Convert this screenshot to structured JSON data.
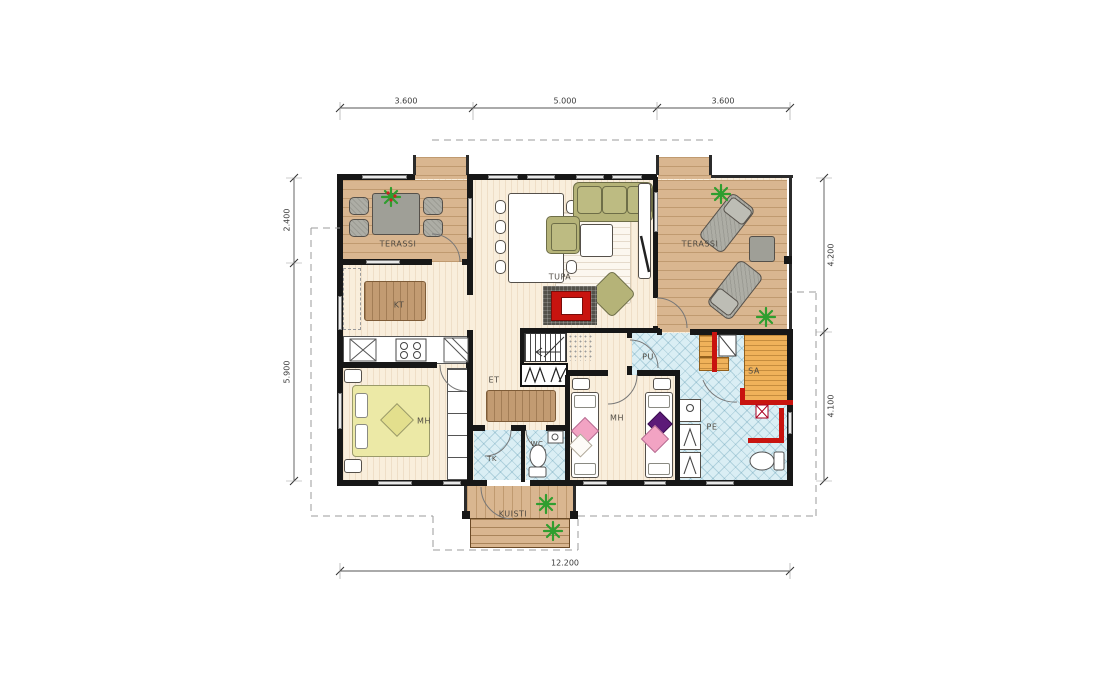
{
  "drawing": {
    "type": "architectural floor plan"
  },
  "rooms": {
    "terassi_left": "TERASSI",
    "terassi_right": "TERASSI",
    "tupa": "TUPA",
    "kt": "KT",
    "et": "ET",
    "mh_left": "MH",
    "mh_right": "MH",
    "tk": "TK",
    "wc": "WC",
    "pu": "PU",
    "sa": "SA",
    "pe": "PE",
    "kuisti": "KUISTI"
  },
  "dimensions": {
    "top": [
      "3.600",
      "5.000",
      "3.600"
    ],
    "left": [
      "2.400",
      "5.900"
    ],
    "right": [
      "4.200",
      "4.100"
    ],
    "bottom": [
      "12.200"
    ]
  },
  "colors": {
    "wall": "#171717",
    "wood_deck": "#d9b690",
    "interior_floor": "#f9eedc",
    "wet_room_tile": "#daeef4",
    "sauna_bench": "#f0b25a",
    "accent_red": "#c8140f",
    "furniture_olive": "#b5b378",
    "bed_yellow": "#ece9a6",
    "plant_green": "#2f9e2f"
  }
}
